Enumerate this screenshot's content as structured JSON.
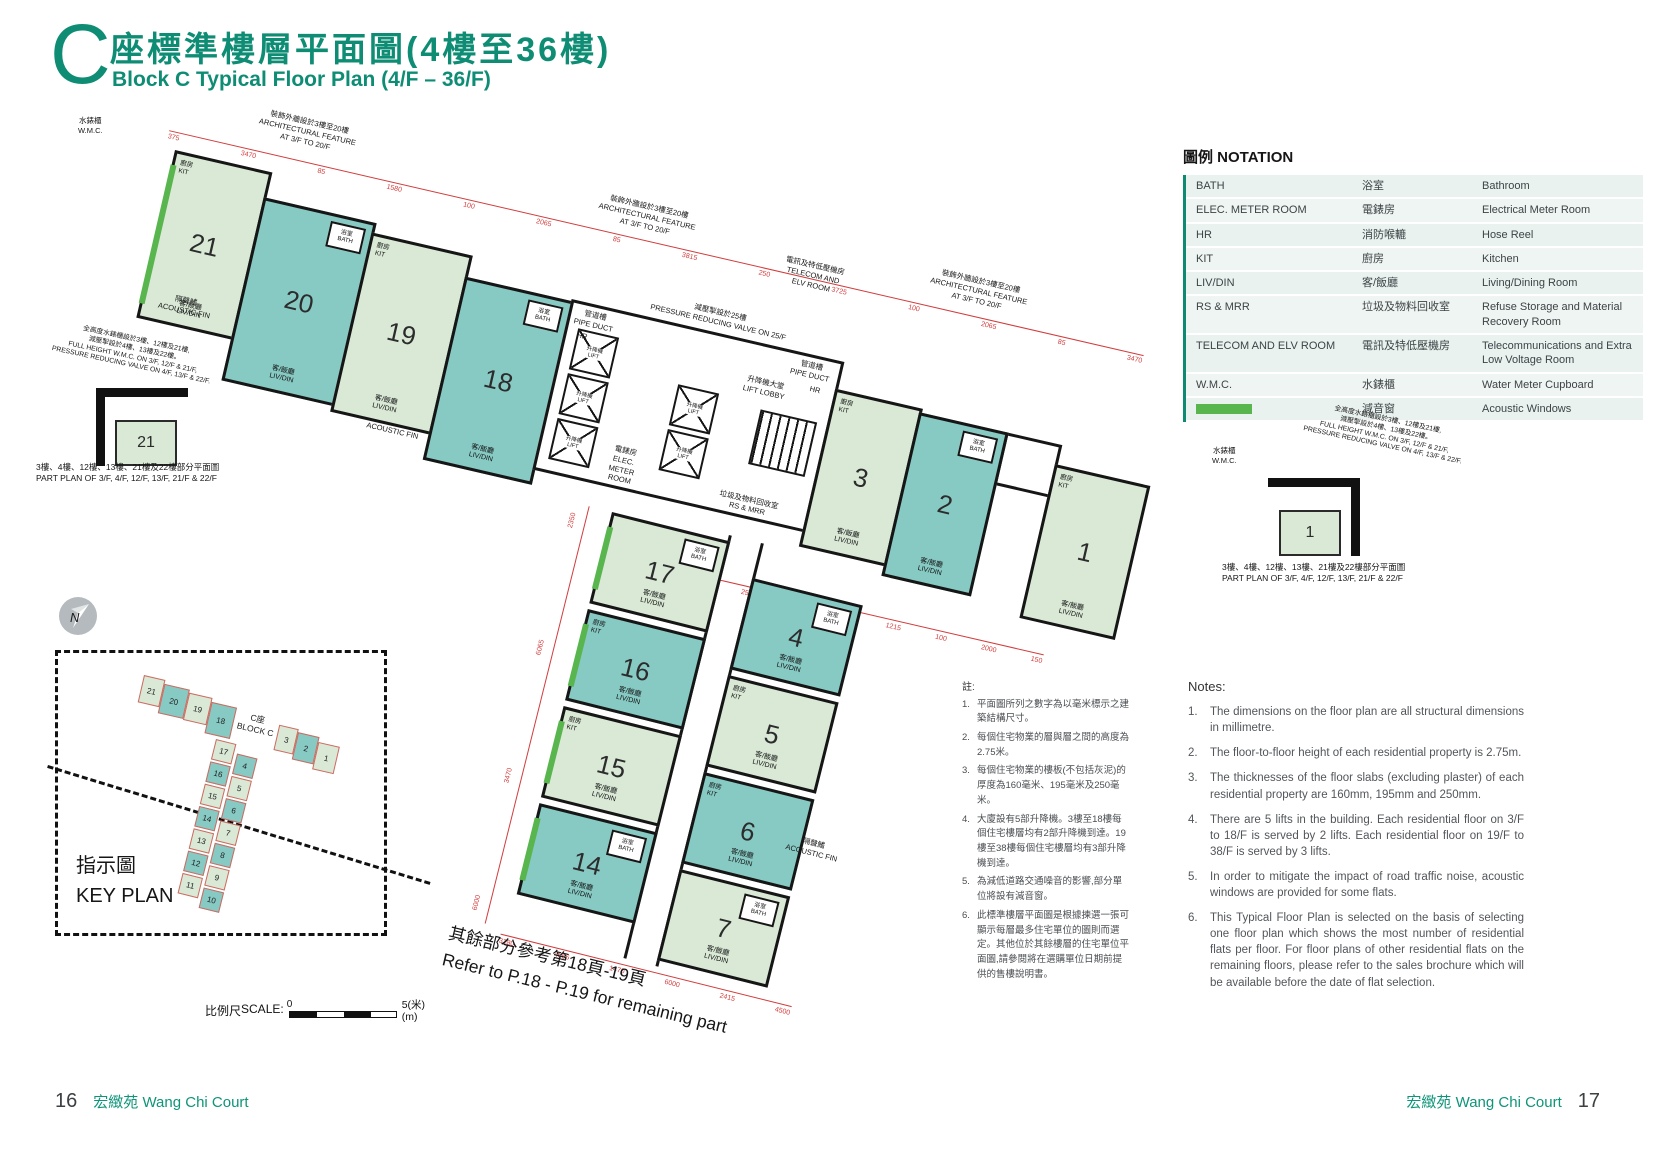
{
  "header": {
    "block_letter": "C",
    "title_zh": "座標準樓層平面圖(4樓至36樓)",
    "title_en": "Block C Typical Floor Plan (4/F – 36/F)"
  },
  "notation": {
    "title": "圖例 NOTATION",
    "rows": [
      {
        "abbr": "BATH",
        "zh": "浴室",
        "en": "Bathroom"
      },
      {
        "abbr": "ELEC. METER ROOM",
        "zh": "電錶房",
        "en": "Electrical Meter Room"
      },
      {
        "abbr": "HR",
        "zh": "消防喉轆",
        "en": "Hose Reel"
      },
      {
        "abbr": "KIT",
        "zh": "廚房",
        "en": "Kitchen"
      },
      {
        "abbr": "LIV/DIN",
        "zh": "客/飯廳",
        "en": "Living/Dining Room"
      },
      {
        "abbr": "RS & MRR",
        "zh": "垃圾及物料回收室",
        "en": "Refuse Storage and Material Recovery Room"
      },
      {
        "abbr": "TELECOM AND ELV ROOM",
        "zh": "電訊及特低壓機房",
        "en": "Telecommunications and Extra Low Voltage Room"
      },
      {
        "abbr": "W.M.C.",
        "zh": "水錶櫃",
        "en": "Water Meter Cupboard"
      }
    ],
    "acoustic": {
      "zh": "減音窗",
      "en": "Acoustic Windows",
      "swatch_color": "#59b54e"
    }
  },
  "plan": {
    "units_top": [
      "21",
      "20",
      "19",
      "18"
    ],
    "units_right": [
      "3",
      "2",
      "1"
    ],
    "units_bottom_left": [
      "17",
      "16",
      "15",
      "14"
    ],
    "units_bottom_right": [
      "4",
      "5",
      "6",
      "7"
    ],
    "part_plan_left_no": "21",
    "part_plan_right_no": "1",
    "rooms": {
      "livdin": "客/飯廳\nLIV/DIN",
      "kit": "廚房\nKIT",
      "bath": "浴室\nBATH",
      "lift": "升降機\nLIFT",
      "hr": "HR"
    },
    "annotations": {
      "wmc": "水錶櫃\nW.M.C.",
      "arch_feature": "裝飾外牆設於3樓至20樓\nARCHITECTURAL FEATURE\nAT 3/F TO 20/F",
      "acoustic_fin": "隔聲鰭\nACOUSTIC FIN",
      "telecom": "電訊及特低壓機房\nTELECOM AND\nELV ROOM",
      "prv": "減壓掣設於25樓\nPRESSURE REDUCING VALVE ON 25/F",
      "pipe_duct": "管道槽\nPIPE DUCT",
      "lift_lobby": "升降機大堂\nLIFT LOBBY",
      "elec_meter": "電錶房\nELEC.\nMETER\nROOM",
      "rs_mrr": "垃圾及物料回收室\nRS & MRR",
      "full_height": "全高度水錶櫃設於3樓、12樓及21樓,\n減壓掣設於4樓、13樓及22樓。\nFULL HEIGHT W.M.C. ON 3/F, 12/F & 21/F,\nPRESSURE REDUCING VALVE ON 4/F, 13/F & 22/F.",
      "part_plan_caption": "3樓、4樓、12樓、13樓、21樓及22樓部分平面圖\nPART PLAN OF 3/F, 4/F, 12/F, 13/F, 21/F & 22/F",
      "refer": "其餘部分參考第18頁-19頁\nRefer to P.18 - P.19 for remaining part"
    },
    "dims_top": [
      "375",
      "3470",
      "85",
      "1580",
      "100",
      "2065",
      "85",
      "3815",
      "250",
      "3725",
      "100",
      "2065",
      "85",
      "3470"
    ],
    "dims_right": [
      "2550",
      "250",
      "1100",
      "1035",
      "1215",
      "100",
      "2000",
      "150"
    ],
    "dims_left": [
      "2350",
      "6065",
      "3470",
      "6000"
    ],
    "dims_bottom": [
      "3180",
      "4655",
      "1470",
      "6000",
      "2415",
      "4500"
    ]
  },
  "key_plan": {
    "title_zh": "指示圖",
    "title_en": "KEY PLAN",
    "north": "N",
    "block_label": "C座\nBLOCK C",
    "top_units": [
      "21",
      "20",
      "19",
      "18"
    ],
    "right_units": [
      "3",
      "2",
      "1"
    ],
    "left_col": [
      "17",
      "16",
      "15",
      "14",
      "13",
      "12",
      "11"
    ],
    "right_col": [
      "4",
      "5",
      "6",
      "7",
      "8",
      "9",
      "10"
    ]
  },
  "scale_bar": {
    "label_zh": "比例尺",
    "label_en": "SCALE:",
    "start": "0",
    "end": "5(米)",
    "unit": "(m)"
  },
  "note_numbers": [
    "1.",
    "2.",
    "3.",
    "4.",
    "5.",
    "6."
  ],
  "notes_zh": {
    "title": "註:",
    "items": [
      "平面圖所列之數字為以毫米標示之建築結構尺寸。",
      "每個住宅物業的層與層之間的高度為2.75米。",
      "每個住宅物業的樓板(不包括灰泥)的厚度為160毫米、195毫米及250毫米。",
      "大廈設有5部升降機。3樓至18樓每個住宅樓層均有2部升降機到達。19樓至38樓每個住宅樓層均有3部升降機到達。",
      "為減低道路交通噪音的影響,部分單位將設有減音窗。",
      "此標準樓層平面圖是根據揀選一張可顯示每層最多住宅單位的圖則而選定。其他位於其餘樓層的住宅單位平面圖,請參閱將在選購單位日期前提供的售樓說明書。"
    ]
  },
  "notes_en": {
    "title": "Notes:",
    "items": [
      "The dimensions on the floor plan are all structural dimensions in millimetre.",
      "The floor-to-floor height of each residential property is 2.75m.",
      "The thicknesses of the floor slabs (excluding plaster) of each residential property are 160mm, 195mm and 250mm.",
      "There are 5 lifts in the building. Each residential floor on 3/F to 18/F is served by 2 lifts. Each residential floor on 19/F to 38/F is served by 3 lifts.",
      "In order to mitigate the impact of road traffic noise, acoustic windows are provided for some flats.",
      "This Typical Floor Plan is selected on the basis of selecting one floor plan which shows the most number of residential flats per floor. For floor plans of other residential flats on the remaining floors, please refer to the sales brochure which will be available before the date of flat selection."
    ]
  },
  "footer": {
    "left_page": "16",
    "right_page": "17",
    "name_zh": "宏緻苑",
    "name_en": "Wang Chi Court"
  },
  "colors": {
    "accent": "#0e8d74",
    "teal_unit": "#87c9c3",
    "green_unit": "#d9e9d6",
    "acoustic_window": "#59b54e",
    "dimension_red": "#d23b3b"
  }
}
